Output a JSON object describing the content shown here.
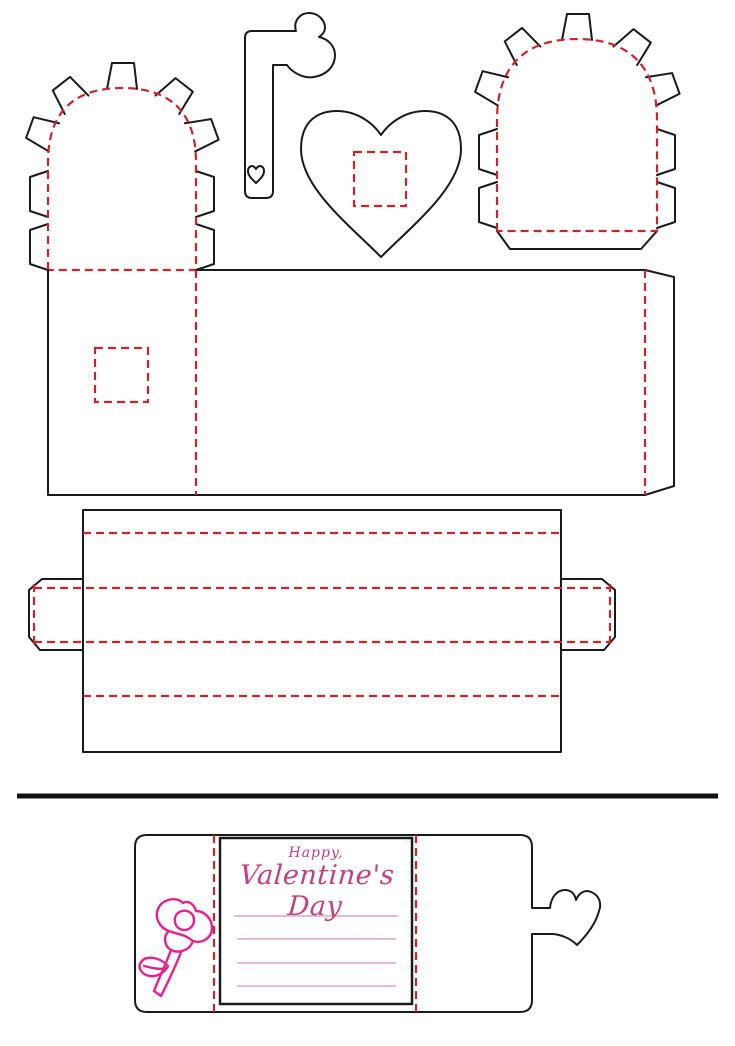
{
  "colors": {
    "cut_line": "#1a1a1a",
    "fold_line": "#c9252c",
    "text_pink": "#c2417c",
    "rose_pink": "#e9218c",
    "writing_line_pink": "#d9a6c3",
    "background": "#ffffff"
  },
  "card": {
    "greeting_top": "Happy,",
    "greeting_main": "Valentine's Day",
    "writing_lines_count": 4
  },
  "pieces": [
    {
      "name": "scalloped-arch-flap-left",
      "line_style": "fold-dashed with cut tabs"
    },
    {
      "name": "heart-key",
      "line_style": "cut"
    },
    {
      "name": "heart-with-window",
      "line_style": "cut with fold-dashed window"
    },
    {
      "name": "scalloped-arch-flap-right",
      "line_style": "fold-dashed with cut tabs"
    },
    {
      "name": "box-body-panel",
      "line_style": "cut with fold-dashed creases"
    },
    {
      "name": "box-sleeve-panel",
      "line_style": "cut with fold-dashed creases"
    },
    {
      "name": "divider-rule",
      "line_style": "thick cut"
    },
    {
      "name": "valentine-card",
      "line_style": "cut with fold-dashed creases"
    }
  ]
}
